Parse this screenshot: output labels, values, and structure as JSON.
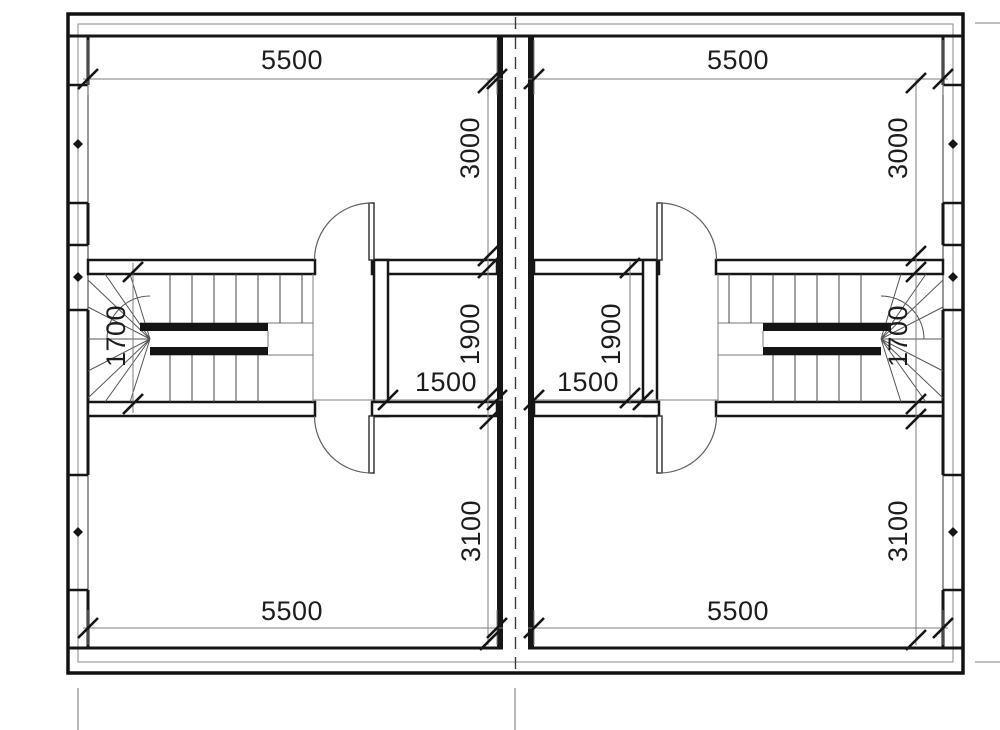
{
  "drawing": {
    "title": "duplex-upper-floor-plan",
    "units": {
      "left": {
        "top_room_width": "5500",
        "bottom_room_width": "5500",
        "top_room_depth": "3000",
        "bottom_room_depth": "3100",
        "closet_width": "1500",
        "closet_depth": "1900",
        "stair_depth": "1700"
      },
      "right": {
        "top_room_width": "5500",
        "bottom_room_width": "5500",
        "top_room_depth": "3000",
        "bottom_room_depth": "3100",
        "closet_width": "1500",
        "closet_depth": "1900",
        "stair_depth": "1700"
      }
    },
    "colors": {
      "line": "#161616",
      "thin_line": "#777777",
      "background": "#ffffff"
    }
  }
}
